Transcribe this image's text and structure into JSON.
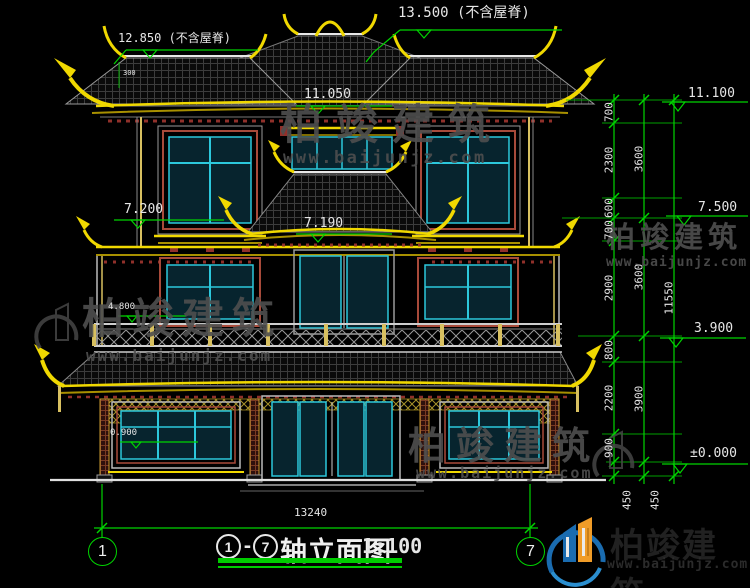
{
  "drawing": {
    "top_ridge_dim": "13.500 (不含屋脊)",
    "left_ridge_dim": "12.850 (不含屋脊)",
    "small_dim": "300",
    "level_eave": "11.050",
    "level_band_left": "7.200",
    "level_band_mid": "7.190",
    "level_balcony": "4.800",
    "level_sill": "0.900",
    "bottom_dim": "13240"
  },
  "right_levels": [
    "11.100",
    "7.500",
    "3.900",
    "±0.000"
  ],
  "dims": {
    "chain_a": [
      "700",
      "2300",
      "600",
      "700",
      "2900",
      "800",
      "2200",
      "900"
    ],
    "chain_a_foot": "450",
    "chain_b": [
      "3600",
      "3600",
      "3900"
    ],
    "chain_b_foot": "450",
    "total": "11550"
  },
  "axes": {
    "left": "1",
    "right": "7"
  },
  "titlebar": {
    "dash": "-",
    "title": "轴立面图",
    "scale": "1:100"
  },
  "watermark": {
    "brand": "柏竣建筑",
    "site": "www.baijunjz.com"
  },
  "logo": {
    "brand": "柏竣建筑",
    "site": "www.baijunjz.com"
  },
  "colors": {
    "dim_green": "#00d400",
    "eave_yellow": "#f0d800",
    "glass_cyan": "#2cc8dc",
    "accent_red": "#90302a"
  }
}
